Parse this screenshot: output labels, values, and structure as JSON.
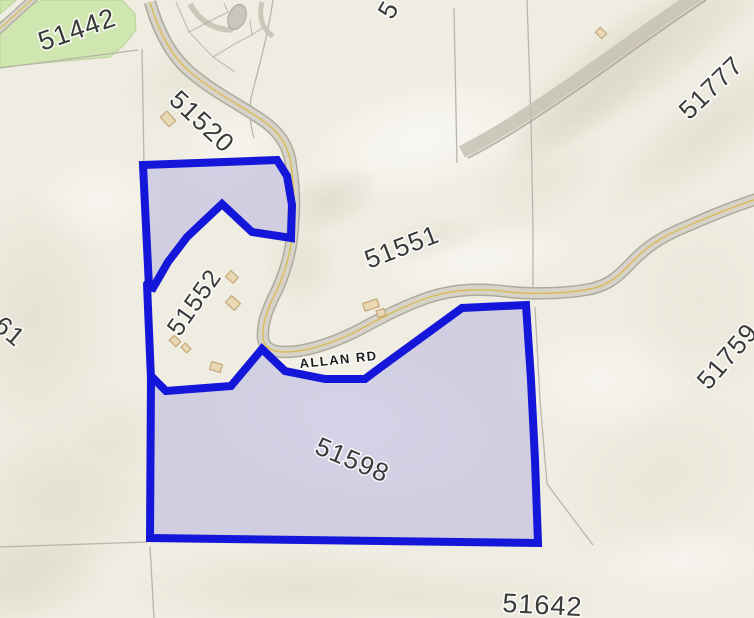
{
  "map": {
    "title": "Cadastral parcel map with selection highlight",
    "road_label": "ALLAN RD",
    "labels": {
      "p51442": "51442",
      "p51520": "51520",
      "p5": "5",
      "p51777": "51777",
      "p51551": "51551",
      "p51552": "51552",
      "p61": "61",
      "p51759": "51759",
      "p51598": "51598",
      "p51642": "51642"
    },
    "selected_parcels": [
      "51552",
      "51598"
    ],
    "colors": {
      "background": "#efece1",
      "selection_outline": "#1416d9",
      "selection_fill": "#aaaadf",
      "greenspace": "#cfe6b1",
      "road": "#d7d3c9",
      "road_edge": "#a9a59b",
      "road_centerline": "#d9bc57",
      "parcel_line": "#b3afa6",
      "building": "#e8d8b4",
      "building_outline": "#c5a878",
      "label_color": "#3a3a3a"
    }
  }
}
